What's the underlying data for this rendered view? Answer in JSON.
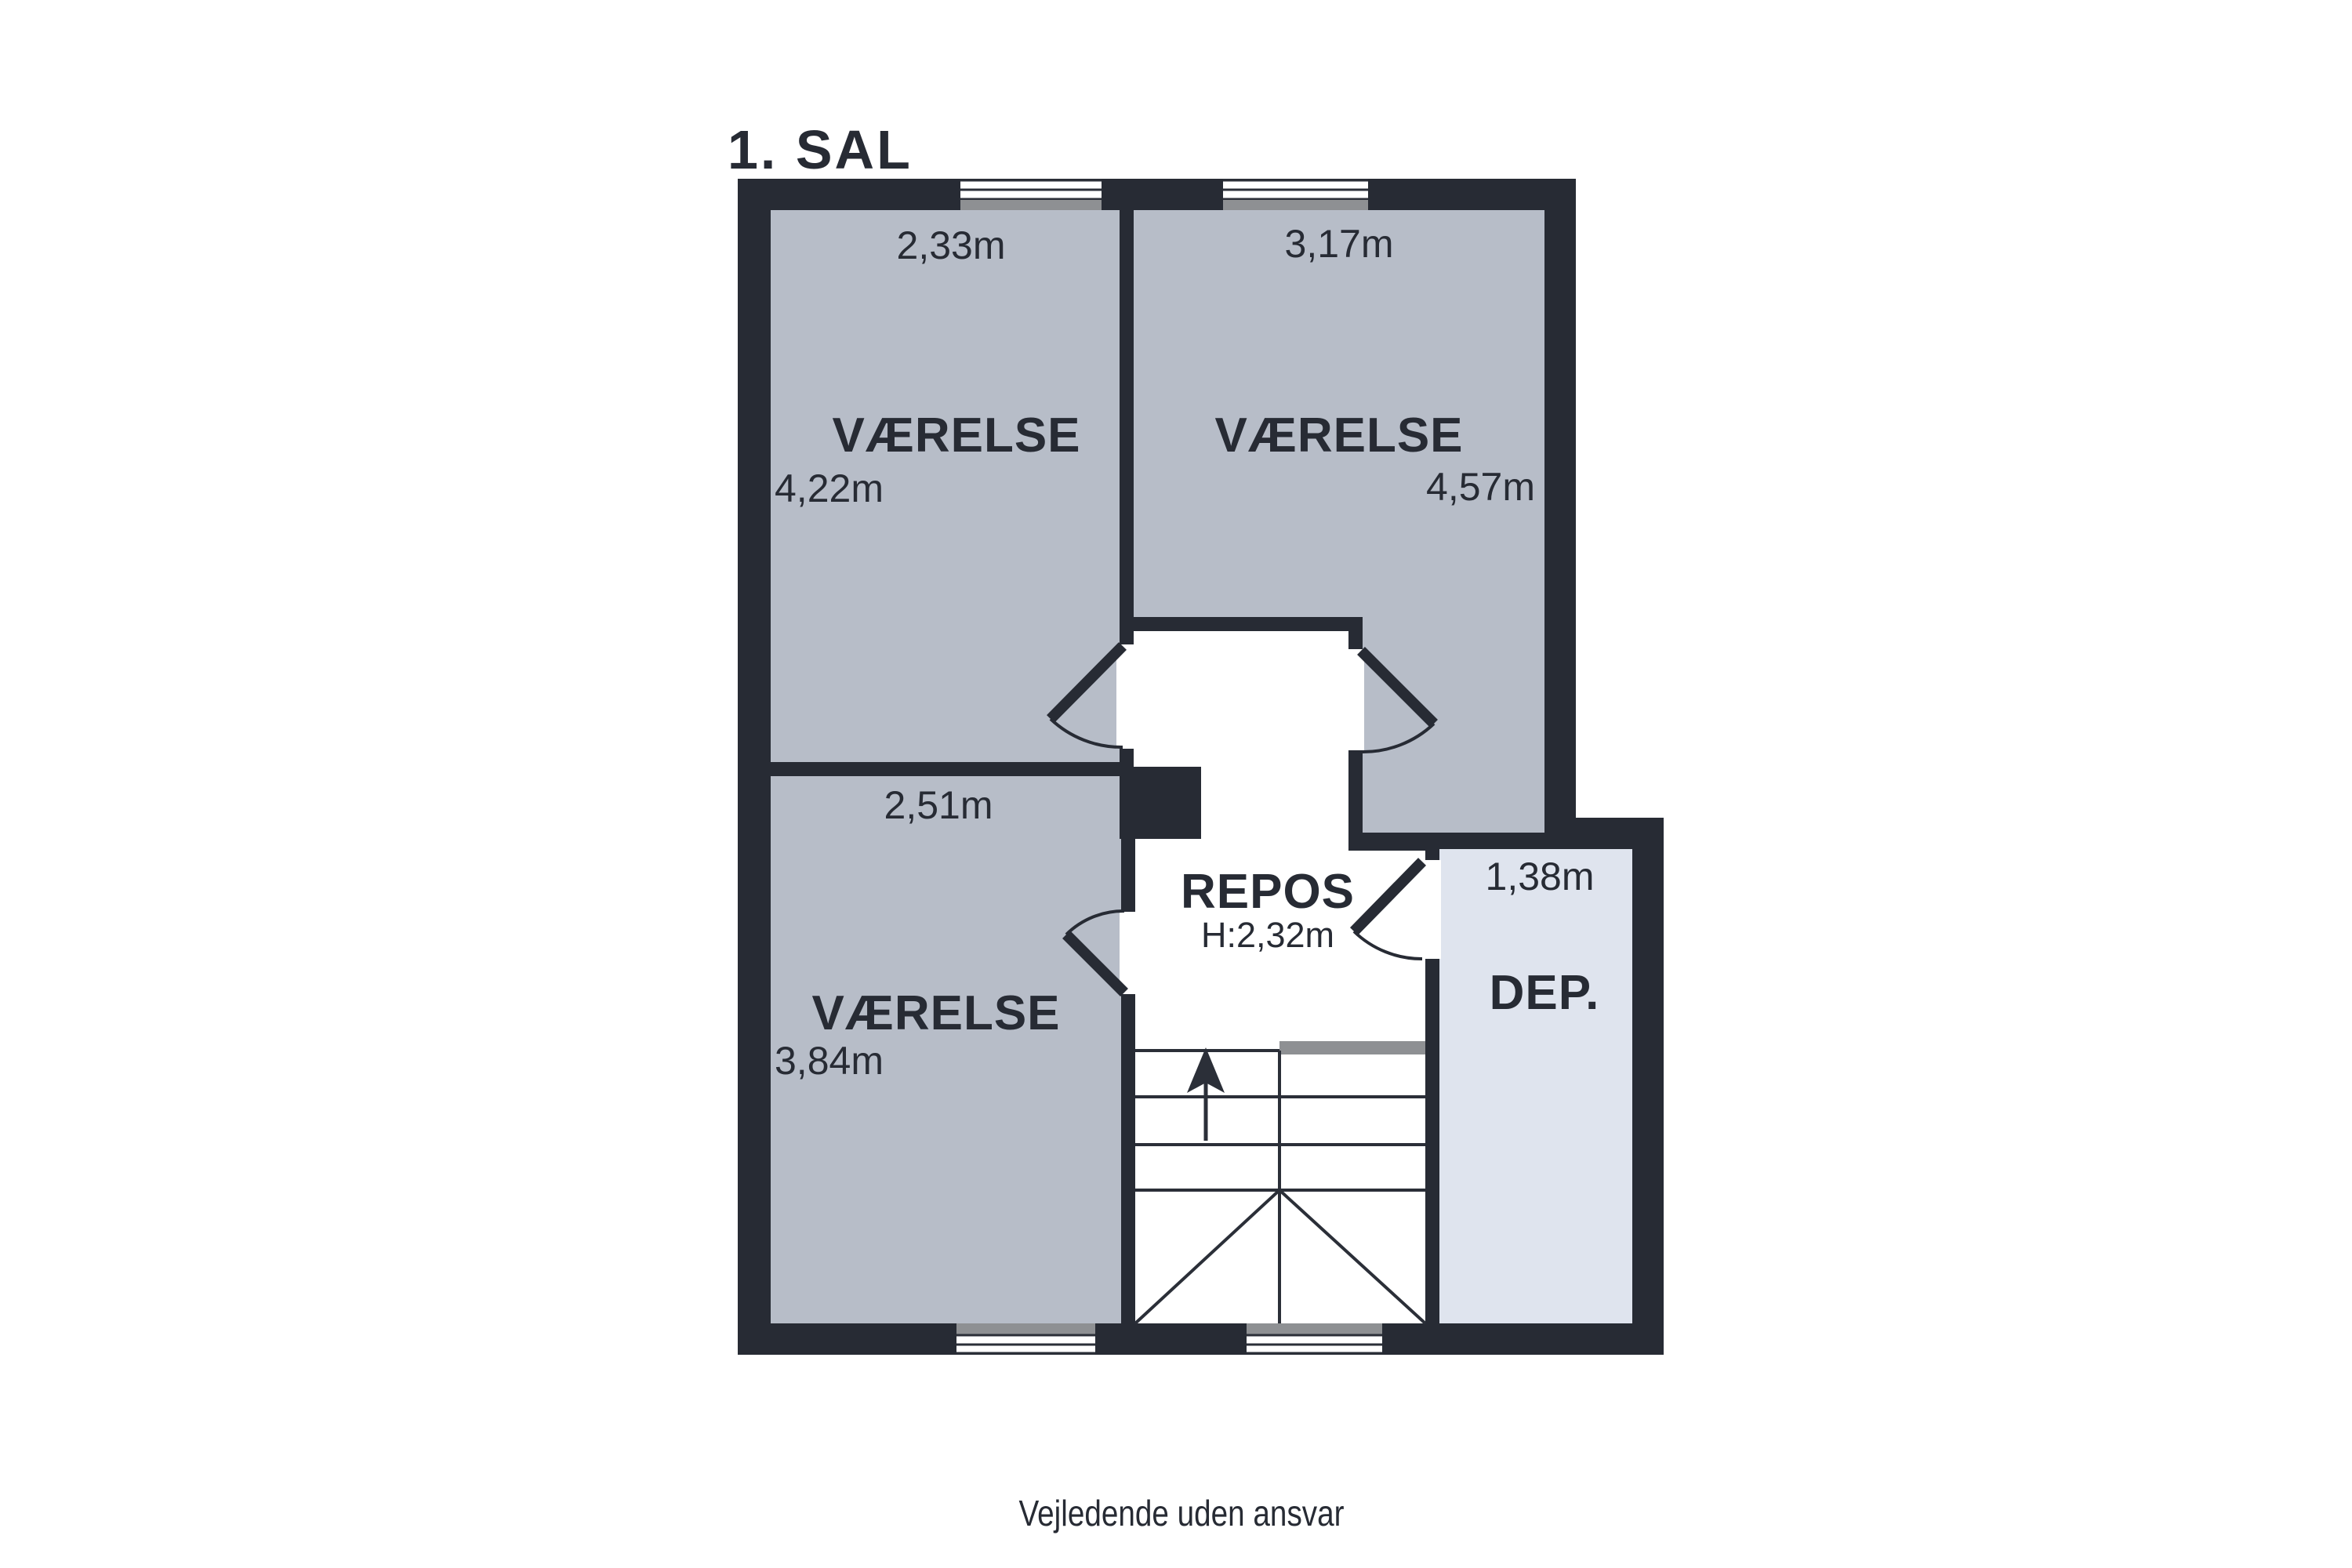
{
  "title": "1. SAL",
  "footer": "Vejledende uden ansvar",
  "colors": {
    "wall": "#272b34",
    "room_fill": "#b7bdc8",
    "storage_fill": "#dfe4ee",
    "window_sill": "#8e9093",
    "text": "#272b34",
    "background": "#ffffff"
  },
  "rooms": {
    "bedroom_top_left": {
      "name": "VÆRELSE",
      "width": "2,33m",
      "depth": "4,22m"
    },
    "bedroom_top_right": {
      "name": "VÆRELSE",
      "width": "3,17m",
      "depth": "4,57m"
    },
    "bedroom_bottom_left": {
      "name": "VÆRELSE",
      "width": "2,51m",
      "depth": "3,84m"
    },
    "landing": {
      "name": "REPOS",
      "ceiling_height": "H:2,32m"
    },
    "storage": {
      "name": "DEP.",
      "width": "1,38m"
    }
  }
}
